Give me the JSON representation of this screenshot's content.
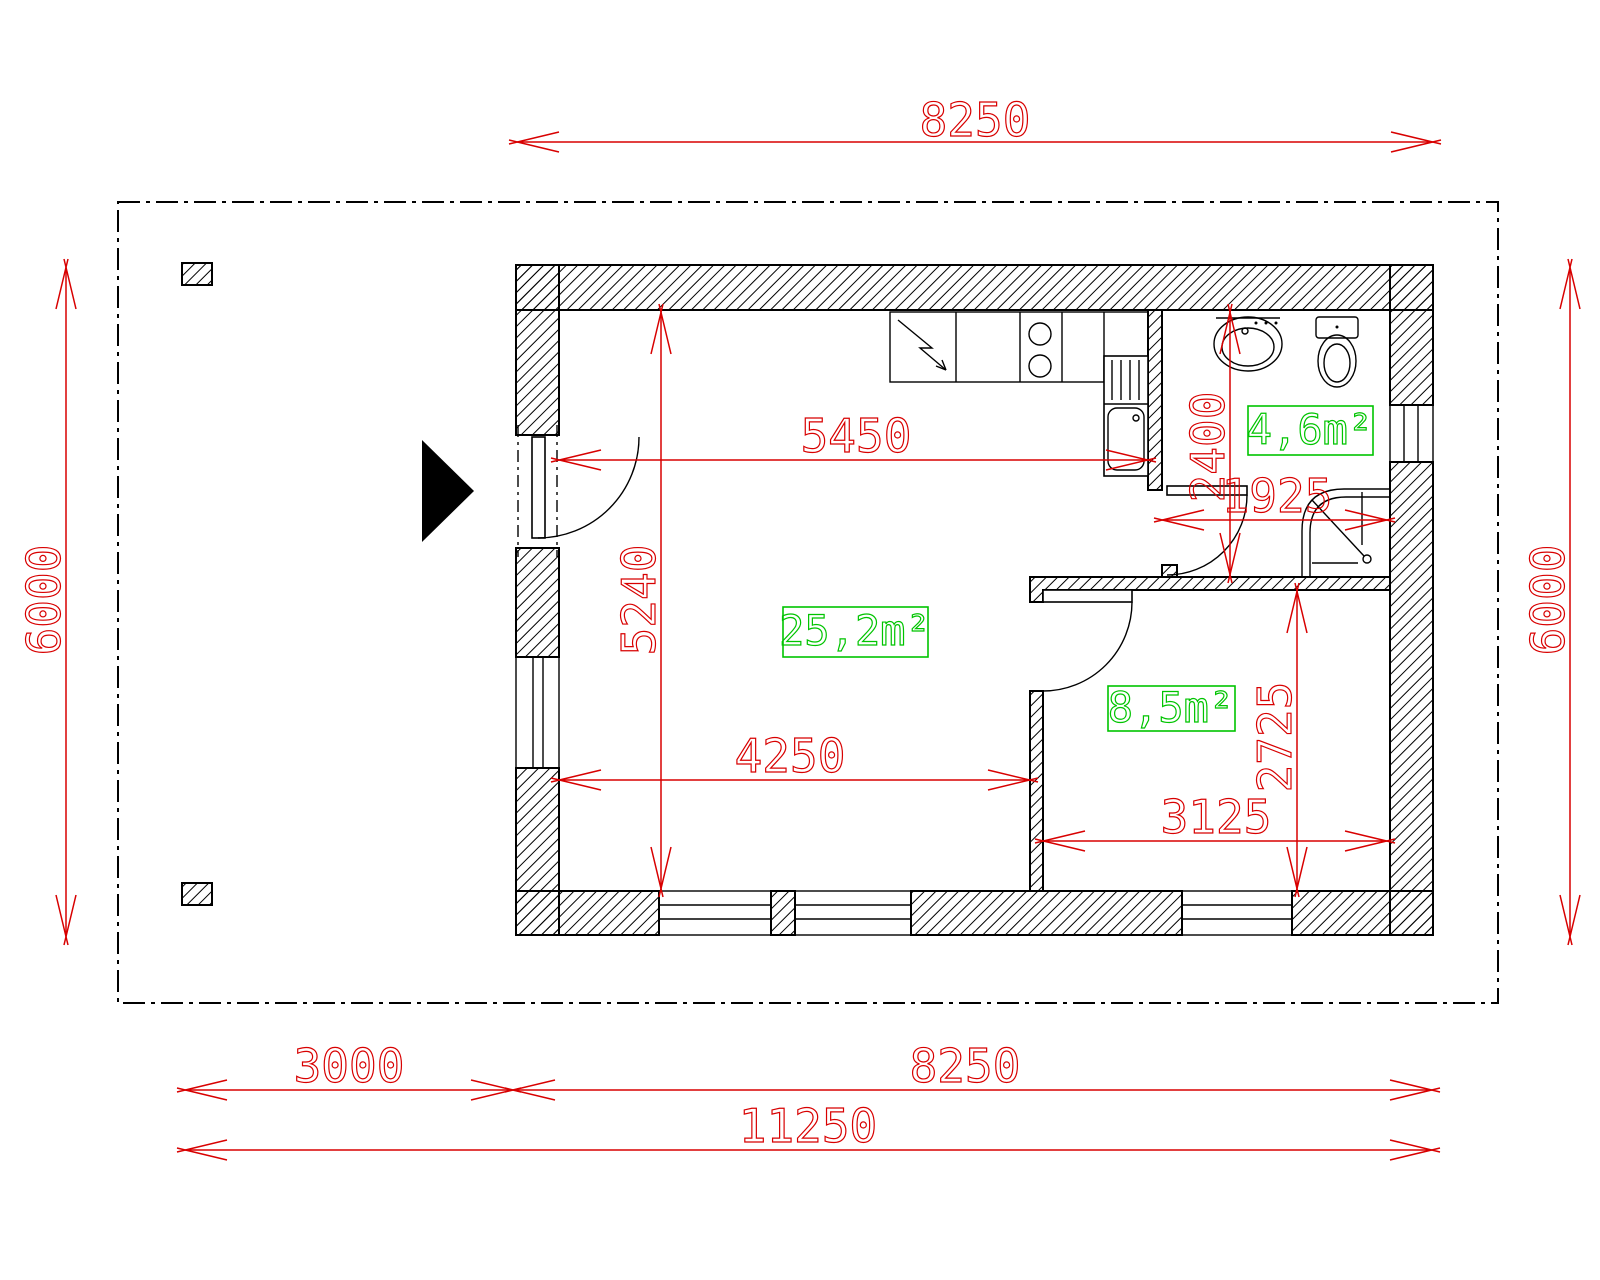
{
  "drawing": {
    "type": "floor-plan",
    "colors": {
      "dimension": "#d80000",
      "area_label": "#00c400",
      "linework": "#000000",
      "background": "#ffffff"
    },
    "overall_dimensions": {
      "top_width": "8250",
      "left_height": "6000",
      "right_height": "6000",
      "bottom_segment_left": "3000",
      "bottom_segment_right": "8250",
      "bottom_total": "11250"
    },
    "interior_dimensions": {
      "living_room_width_top": "5450",
      "living_room_height": "5240",
      "living_room_width_bottom": "4250",
      "bathroom_height": "2400",
      "bathroom_width": "1925",
      "bedroom_height": "2725",
      "bedroom_width": "3125"
    },
    "room_areas": {
      "living_room": "25,2m²",
      "bedroom": "8,5m²",
      "bathroom": "4,6m²"
    }
  }
}
